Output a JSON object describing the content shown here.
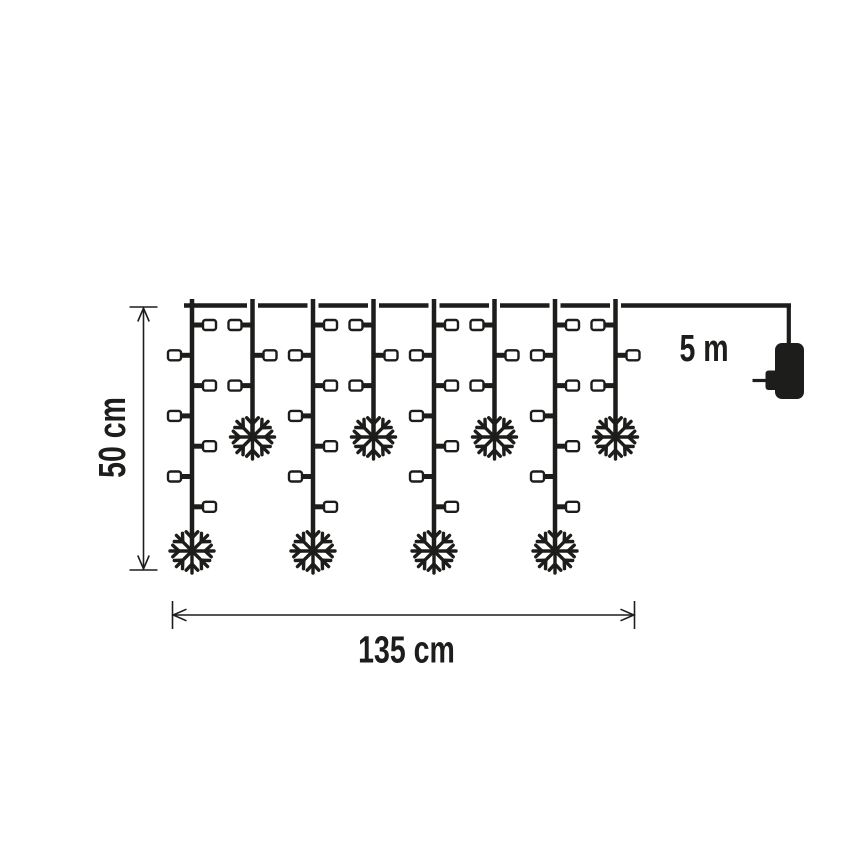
{
  "diagram": {
    "type": "product-dimension-diagram",
    "subject": "christmas icicle light curtain with snowflake pendants and power plug",
    "background": "#ffffff",
    "line_color": "#1d1d1b",
    "bulb_fill": "#ffffff",
    "dimensions": {
      "drop_height": "50 cm",
      "curtain_width": "135 cm",
      "lead_cable_length": "5 m"
    },
    "curtain": {
      "strand_pattern": [
        "long",
        "short",
        "long",
        "short",
        "long",
        "short",
        "long",
        "short"
      ],
      "long_bulb_sides": [
        "right",
        "left",
        "right",
        "left",
        "right",
        "left",
        "right"
      ],
      "short_bulb_sides": [
        "left",
        "right",
        "left"
      ],
      "snowflakes_per_strand": 1
    }
  }
}
